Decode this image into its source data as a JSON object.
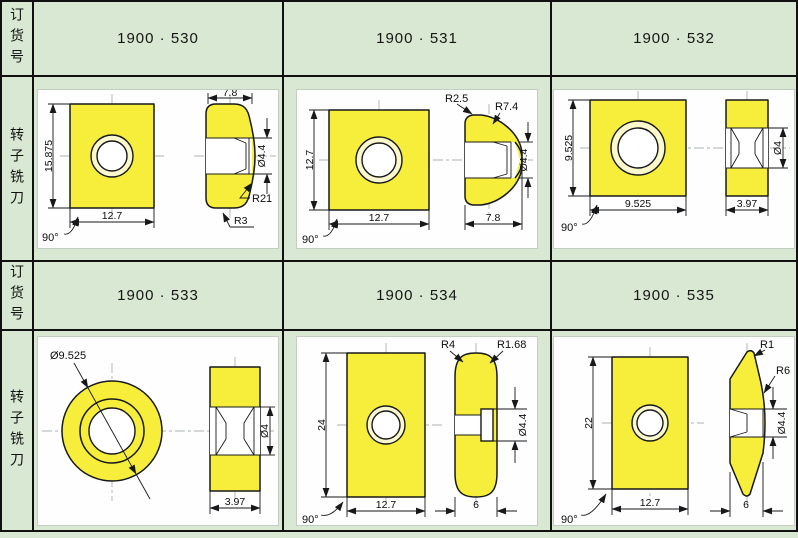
{
  "palette": {
    "background_green": "#d9e8d2",
    "panel_white": "#fefefe",
    "insert_yellow": "#f6ee3b",
    "line_black": "#17181a"
  },
  "table": {
    "order_header": "订货号",
    "cutter_header": "转子铣刀"
  },
  "orders": {
    "o530": "1900 · 530",
    "o531": "1900 · 531",
    "o532": "1900 · 532",
    "o533": "1900 · 533",
    "o534": "1900 · 534",
    "o535": "1900 · 535"
  },
  "drawings": {
    "d530": {
      "height": "15.875",
      "width": "12.7",
      "angle": "90°",
      "side_width": "7.8",
      "hole_dia": "Ø4.4",
      "radius_large": "R21",
      "radius_small": "R3"
    },
    "d531": {
      "height": "12.7",
      "width": "12.7",
      "angle": "90°",
      "radius_small": "R2.5",
      "radius_large": "R7.4",
      "hole_dia": "Ø4.4",
      "side_width": "7.8"
    },
    "d532": {
      "height": "9.525",
      "width": "9.525",
      "angle": "90°",
      "hole_dia": "Ø4",
      "side_width": "3.97"
    },
    "d533": {
      "outer_dia": "Ø9.525",
      "hole_dia": "Ø4",
      "side_width": "3.97"
    },
    "d534": {
      "height": "24",
      "width": "12.7",
      "angle": "90°",
      "radius_top": "R4",
      "radius_edge": "R1.68",
      "hole_dia": "Ø4.4",
      "side_width": "6"
    },
    "d535": {
      "height": "22",
      "width": "12.7",
      "angle": "90°",
      "radius_top": "R1",
      "radius_side": "R6",
      "hole_dia": "Ø4.4",
      "side_width": "6"
    }
  }
}
